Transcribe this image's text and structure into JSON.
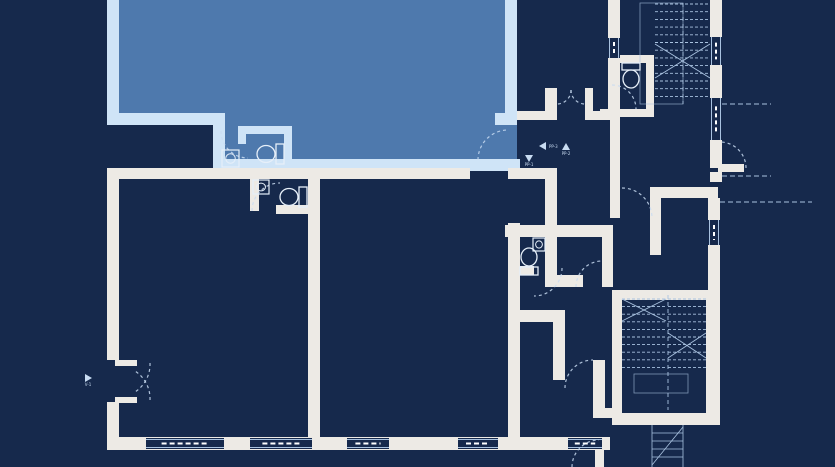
{
  "canvas": {
    "width": 835,
    "height": 467
  },
  "palette": {
    "background": "#16294c",
    "unit_fill": "#4e79ad",
    "unit_wall": "#cfe4f7",
    "wall": "#edeae5",
    "line": "#a9c2e0",
    "dash": "#c9dcf2",
    "fixture": "#e6eff9"
  },
  "highlighted_unit": {
    "fill_points": "119,0 505,0 505,125 517,125 517,163 213,163 213,113 119,113",
    "walls": [
      [
        107,
        0,
        12,
        125
      ],
      [
        107,
        113,
        118,
        12
      ],
      [
        213,
        113,
        12,
        58
      ],
      [
        213,
        159,
        307,
        12
      ],
      [
        505,
        0,
        12,
        125
      ],
      [
        495,
        113,
        22,
        12
      ],
      [
        238,
        126,
        54,
        8
      ],
      [
        284,
        126,
        8,
        46
      ],
      [
        238,
        126,
        8,
        18
      ]
    ]
  },
  "walls": [
    [
      107,
      168,
      363,
      11
    ],
    [
      508,
      168,
      49,
      11
    ],
    [
      107,
      168,
      12,
      192
    ],
    [
      107,
      402,
      12,
      48
    ],
    [
      107,
      437,
      503,
      13
    ],
    [
      308,
      175,
      12,
      262
    ],
    [
      508,
      223,
      12,
      214
    ],
    [
      276,
      205,
      32,
      9
    ],
    [
      250,
      179,
      9,
      32
    ],
    [
      545,
      168,
      12,
      107
    ],
    [
      545,
      275,
      38,
      12
    ],
    [
      602,
      225,
      11,
      62
    ],
    [
      505,
      225,
      108,
      12
    ],
    [
      508,
      266,
      26,
      9
    ],
    [
      517,
      111,
      28,
      9
    ],
    [
      593,
      111,
      27,
      9
    ],
    [
      545,
      88,
      12,
      32
    ],
    [
      585,
      88,
      8,
      32
    ],
    [
      608,
      0,
      12,
      38
    ],
    [
      608,
      58,
      12,
      52
    ],
    [
      600,
      109,
      54,
      8
    ],
    [
      608,
      55,
      46,
      8
    ],
    [
      646,
      55,
      8,
      62
    ],
    [
      610,
      120,
      10,
      98
    ],
    [
      650,
      187,
      68,
      11
    ],
    [
      650,
      195,
      11,
      60
    ],
    [
      710,
      0,
      12,
      37
    ],
    [
      710,
      65,
      12,
      33
    ],
    [
      710,
      140,
      12,
      28
    ],
    [
      710,
      172,
      12,
      10
    ],
    [
      708,
      198,
      12,
      22
    ],
    [
      708,
      245,
      12,
      47
    ],
    [
      612,
      290,
      10,
      135
    ],
    [
      612,
      290,
      106,
      10
    ],
    [
      706,
      290,
      14,
      135
    ],
    [
      612,
      413,
      106,
      12
    ],
    [
      593,
      360,
      12,
      58
    ],
    [
      600,
      408,
      18,
      10
    ],
    [
      508,
      310,
      57,
      12
    ],
    [
      553,
      322,
      12,
      58
    ]
  ],
  "door_leaves": [
    [
      718,
      164,
      26,
      8
    ],
    [
      595,
      440,
      9,
      27
    ],
    [
      115,
      360,
      22,
      6
    ],
    [
      115,
      397,
      22,
      6
    ]
  ],
  "windows_horizontal": [
    [
      146,
      438,
      78
    ],
    [
      250,
      438,
      62
    ],
    [
      347,
      438,
      42
    ],
    [
      458,
      438,
      40
    ],
    [
      568,
      438,
      34
    ]
  ],
  "windows_vertical": [
    [
      608,
      38,
      20
    ],
    [
      710,
      37,
      28
    ],
    [
      710,
      98,
      42
    ],
    [
      708,
      220,
      25
    ]
  ],
  "door_arcs": [
    [
      221,
      131,
      27,
      248,
      158,
      0
    ],
    [
      478,
      160,
      30,
      508,
      130,
      1
    ],
    [
      571,
      90,
      14,
      557,
      104,
      1
    ],
    [
      571,
      90,
      14,
      585,
      104,
      0
    ],
    [
      622,
      188,
      30,
      652,
      218,
      1
    ],
    [
      252,
      211,
      28,
      280,
      183,
      1
    ],
    [
      562,
      268,
      28,
      534,
      296,
      1
    ],
    [
      576,
      287,
      26,
      602,
      261,
      1
    ],
    [
      746,
      168,
      26,
      720,
      142,
      0
    ],
    [
      565,
      388,
      28,
      593,
      360,
      1
    ],
    [
      572,
      467,
      27,
      599,
      440,
      1
    ],
    [
      612,
      85,
      24,
      636,
      109,
      1
    ],
    [
      150,
      363,
      33,
      135,
      392,
      1
    ],
    [
      150,
      400,
      33,
      135,
      371,
      0
    ]
  ],
  "sill_lines": [
    [
      722,
      104,
      771,
      104
    ],
    [
      722,
      176,
      771,
      176
    ],
    [
      720,
      202,
      812,
      202
    ]
  ],
  "stairs": {
    "top": {
      "tread_x1": 655,
      "tread_x2": 710,
      "tread_y0": 4,
      "tread_count": 13,
      "tread_dy": 7.7,
      "cross": [
        [
          655,
          44,
          710,
          78
        ],
        [
          655,
          78,
          710,
          44
        ]
      ],
      "center_x": 683,
      "center_y1": 3,
      "center_y2": 104,
      "box": [
        640,
        3,
        43,
        101
      ]
    },
    "bottom": {
      "runs": [
        [
          622,
          666
        ],
        [
          668,
          706
        ]
      ],
      "y0": 299,
      "count": 10,
      "dy": 7.6,
      "cross": [
        [
          622,
          299,
          666,
          321
        ],
        [
          622,
          321,
          666,
          299
        ],
        [
          668,
          333,
          706,
          358
        ],
        [
          668,
          358,
          706,
          333
        ]
      ],
      "center": [
        668,
        295,
        668,
        410
      ],
      "landing": [
        634,
        374,
        54,
        19
      ]
    },
    "exterior": {
      "lines": [
        [
          652,
          425,
          652,
          467
        ],
        [
          683,
          425,
          683,
          467
        ],
        [
          652,
          433,
          683,
          433
        ],
        [
          652,
          441,
          683,
          441
        ],
        [
          652,
          449,
          683,
          449
        ],
        [
          652,
          457,
          683,
          457
        ],
        [
          652,
          465,
          683,
          427
        ]
      ]
    }
  },
  "fixtures": {
    "toilets": [
      {
        "tank": [
          276,
          144,
          8,
          20
        ],
        "bowl": [
          266,
          154,
          9,
          8.5
        ]
      },
      {
        "tank": [
          299,
          187,
          8,
          20
        ],
        "bowl": [
          289,
          197,
          9,
          8.5
        ]
      },
      {
        "tank": [
          520,
          267,
          18,
          8
        ],
        "bowl": [
          529,
          257,
          8,
          9
        ]
      },
      {
        "tank": [
          622,
          63,
          18,
          7
        ],
        "bowl": [
          631,
          79,
          8,
          9
        ]
      }
    ],
    "sinks": [
      [
        222,
        150,
        17,
        17
      ],
      [
        253,
        180,
        16,
        14
      ],
      [
        533,
        238,
        12,
        13
      ]
    ]
  },
  "markers": {
    "items": [
      {
        "x": 543,
        "y": 146,
        "dir": "left",
        "label": "PP-3"
      },
      {
        "x": 566,
        "y": 147,
        "dir": "up",
        "label": "PP-2"
      },
      {
        "x": 529,
        "y": 158,
        "dir": "down",
        "label": "PP-1"
      },
      {
        "x": 88,
        "y": 378,
        "dir": "right",
        "label": "V-1"
      }
    ]
  }
}
